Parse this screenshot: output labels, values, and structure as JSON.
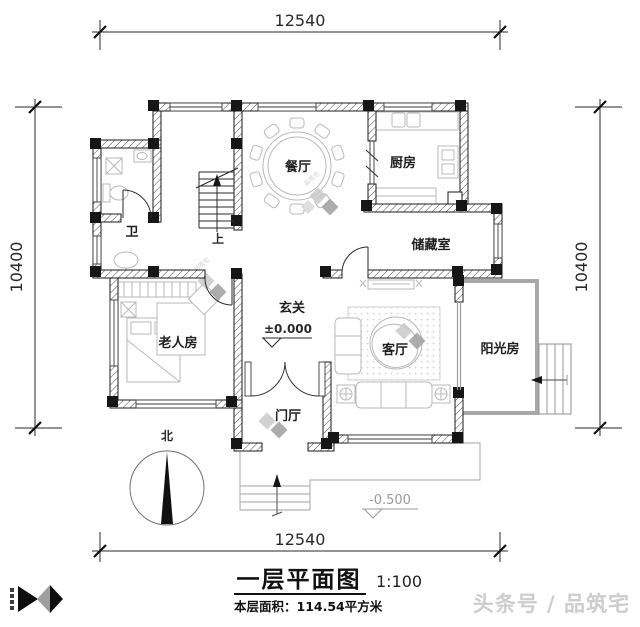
{
  "palette": {
    "ink": "#1a1a1a",
    "furniture_gray": "#b9b9b9",
    "outdoor_gray": "#b3b3b3",
    "watermark_gray": "#cdcdcd"
  },
  "dimensions": {
    "top": "12540",
    "bottom": "12540",
    "left": "10400",
    "right": "10400"
  },
  "rooms": {
    "bath": {
      "label": "卫"
    },
    "dining": {
      "label": "餐厅"
    },
    "kitchen": {
      "label": "厨房"
    },
    "storage": {
      "label": "储藏室"
    },
    "hall": {
      "label": "玄关"
    },
    "elder_room": {
      "label": "老人房"
    },
    "living": {
      "label": "客厅"
    },
    "sunroom": {
      "label": "阳光房"
    },
    "foyer": {
      "label": "门厅"
    }
  },
  "annotations": {
    "stair_up": "上",
    "north": "北",
    "entry_level": "±0.000",
    "ground_level": "-0.500"
  },
  "title_block": {
    "title": "一层平面图",
    "scale": "1:100",
    "area": "本层面积：114.54平方米"
  },
  "branding": {
    "watermark": "头条号 / 品筑宅",
    "inline_logo_text": "品筑宅"
  }
}
